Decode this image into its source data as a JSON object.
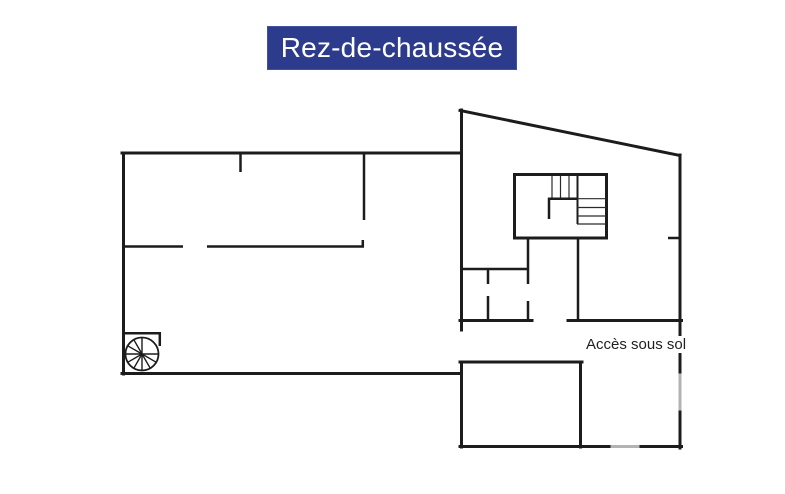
{
  "title_banner": {
    "label": "Rez-de-chaussée",
    "bg_color": "#2d3b8d",
    "text_color": "#ffffff"
  },
  "floor_plan": {
    "labels": {
      "basement_access": "Accès sous sol"
    },
    "features": [
      "left-wing",
      "right-wing",
      "stairwell-icon",
      "spiral-staircase-icon",
      "basement-extension"
    ],
    "colors": {
      "wall": "#1c1c1c",
      "light_wall": "#b3b3b3",
      "background": "#ffffff"
    }
  }
}
